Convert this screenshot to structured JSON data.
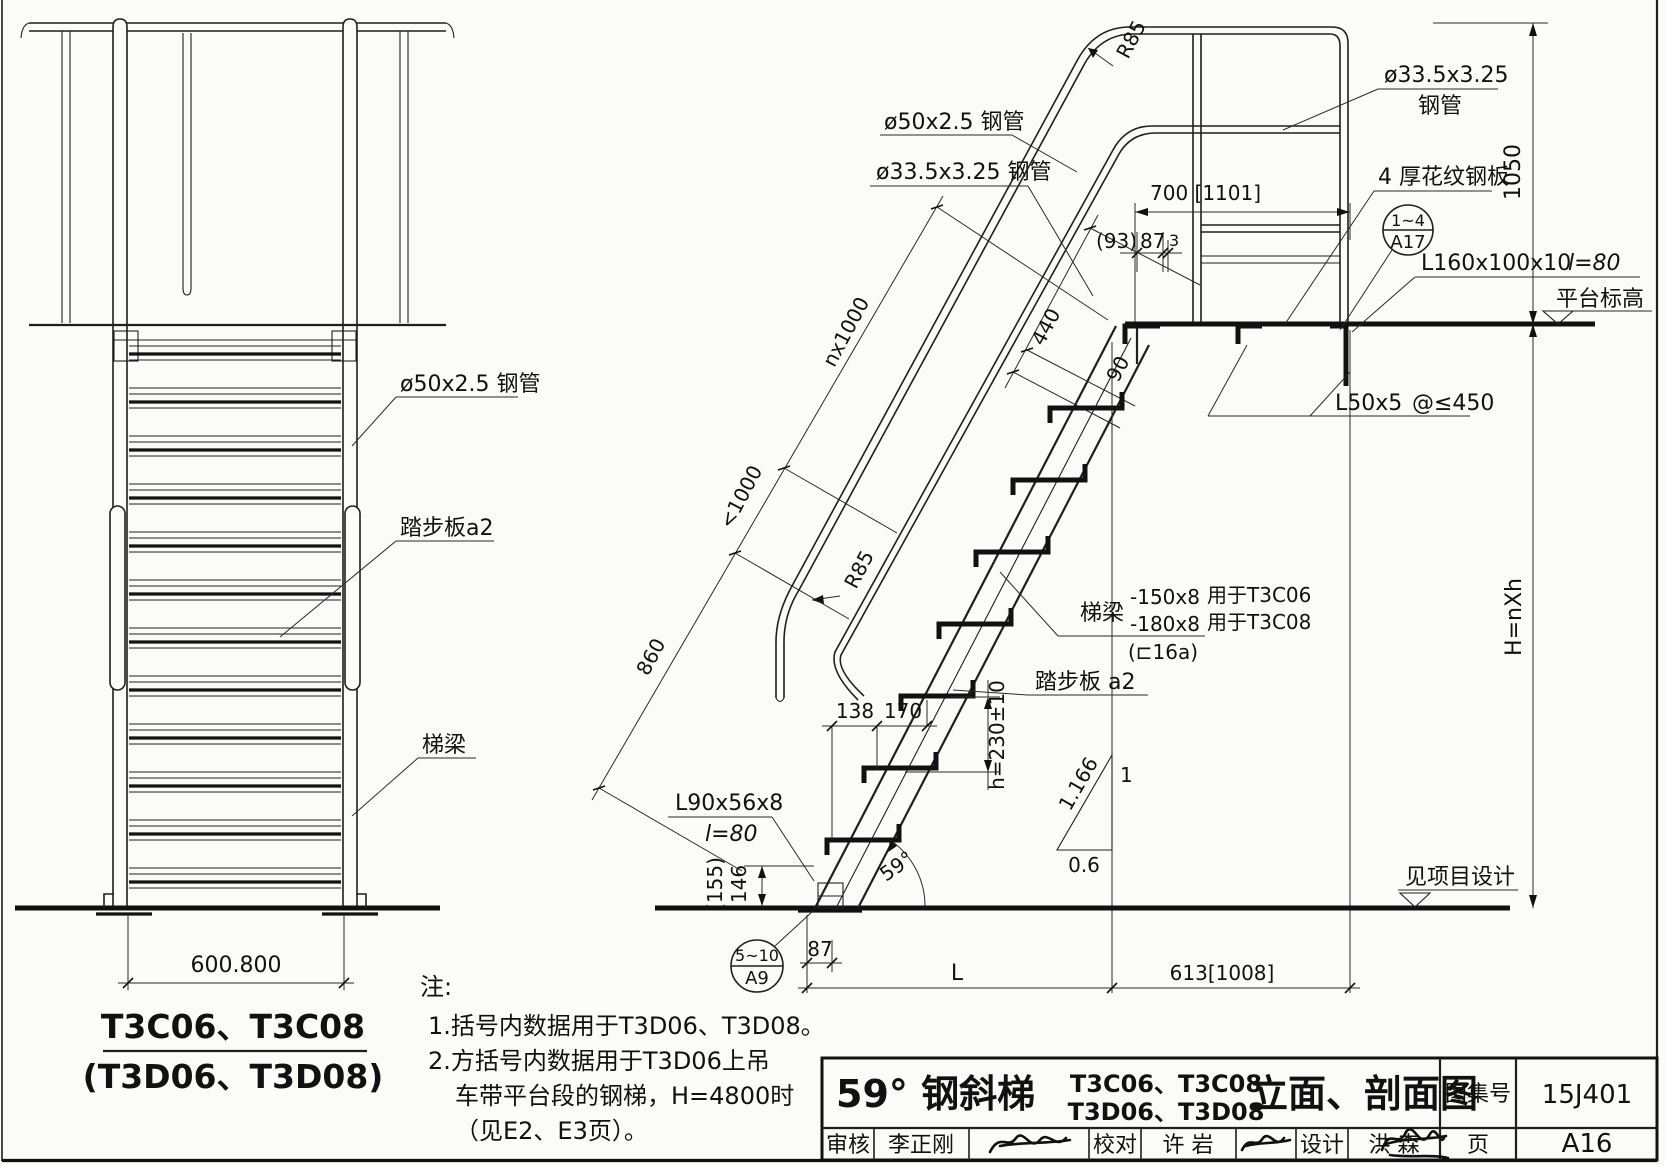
{
  "lv": {
    "dim_width": "600.800",
    "caption1": "T3C06、T3C08",
    "caption2": "(T3D06、T3D08)",
    "label_tube": "ø50x2.5 钢管",
    "label_tread": "踏步板a2",
    "label_beam": "梯梁"
  },
  "rv": {
    "label_rail_tube": "ø50x2.5 钢管",
    "label_mid_tube": "ø33.5x3.25 钢管",
    "r85_top": "R85",
    "r85_bottom": "R85",
    "label_guard_tube1": "ø33.5x3.25",
    "label_guard_tube2": "钢管",
    "label_plate": "4 厚花纹钢板",
    "label_angle_top": "L160x100x10",
    "label_angle_top_len": "l=80",
    "label_platform": "平台标高",
    "label_l50": "L50x5",
    "label_l50_spacing": "@≤450",
    "label_beam": "梯梁",
    "beam_spec1": "-150x8",
    "beam_use1": "用于T3C06",
    "beam_spec2": "-180x8",
    "beam_use2": "用于T3C08",
    "beam_alt": "(⊏16a)",
    "label_tread": "踏步板 a2",
    "label_angle_base": "L90x56x8",
    "label_angle_base_len": "l=80",
    "dim_155": "(155)",
    "dim_146": "146",
    "label_ground": "见项目设计",
    "dim_nx1000": "nx1000",
    "dim_lt1000": "<1000",
    "dim_860": "860",
    "dim_440": "440",
    "dim_90": "90",
    "dim_700": "700 [1101]",
    "dim_93": "(93)",
    "dim_87_top": "87",
    "dim_3": "3",
    "dim_1050": "1050",
    "dim_H": "H=nXh",
    "dim_h230": "h=230±10",
    "dim_138": "138",
    "dim_170": "170",
    "dim_87_base": "87",
    "dim_L": "L",
    "dim_613": "613[1008]",
    "angle_59": "59°",
    "slope_hyp": "1.166",
    "slope_v": "1",
    "slope_h": "0.6",
    "det_a9_top": "5~10",
    "det_a9_bot": "A9",
    "det_a17_top": "1~4",
    "det_a17_bot": "A17"
  },
  "notes": {
    "heading": "注:",
    "note1": "1.括号内数据用于T3D06、T3D08。",
    "note2_line1": "2.方括号内数据用于T3D06上吊",
    "note2_line2": "车带平台段的钢梯，H=4800时",
    "note2_line3": "（见E2、E3页）。"
  },
  "tb": {
    "title_main": "59° 钢斜梯",
    "models1": "T3C06、T3C08",
    "models2": "T3D06、T3D08",
    "title_suffix": "立面、剖面图",
    "atlas_label": "图集号",
    "atlas_no": "15J401",
    "page_label": "页",
    "page_no": "A16",
    "audit_label": "审核",
    "audit_name": "李正刚",
    "proof_label": "校对",
    "proof_name": "许 岩",
    "design_label": "设计",
    "design_name": "洪 森"
  }
}
